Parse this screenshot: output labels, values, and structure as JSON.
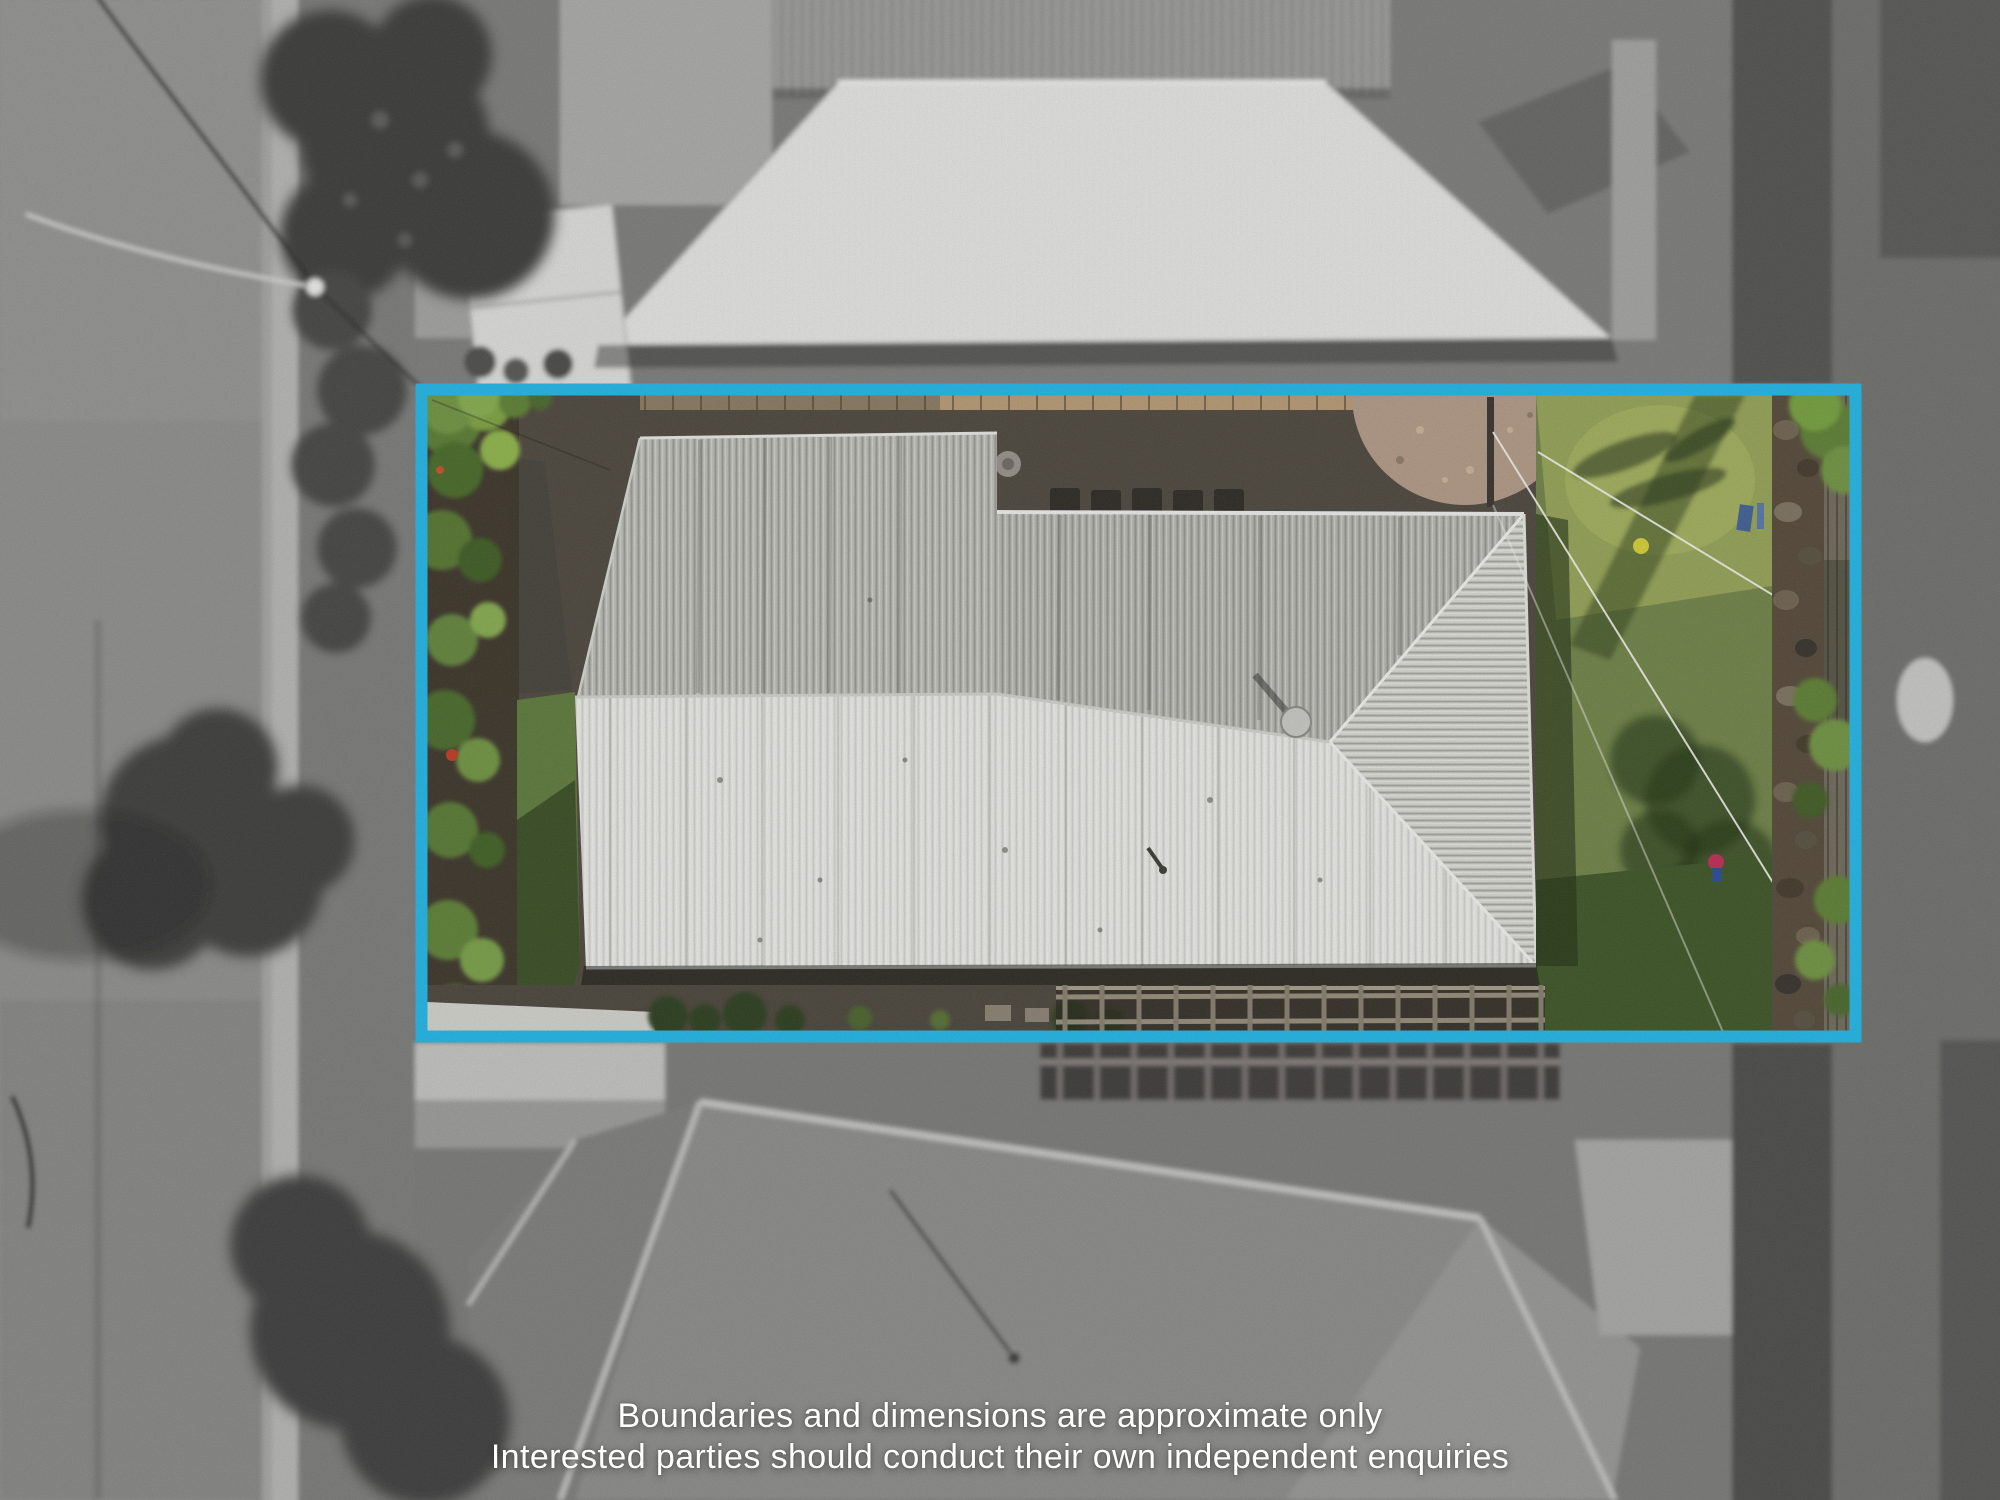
{
  "overlay": {
    "boundary_color": "#1fb7e8",
    "disclaimer": {
      "line1": "Boundaries and dimensions are approximate only",
      "line2": "Interested parties should conduct their own independent enquiries"
    },
    "text_color": "#ffffff"
  }
}
